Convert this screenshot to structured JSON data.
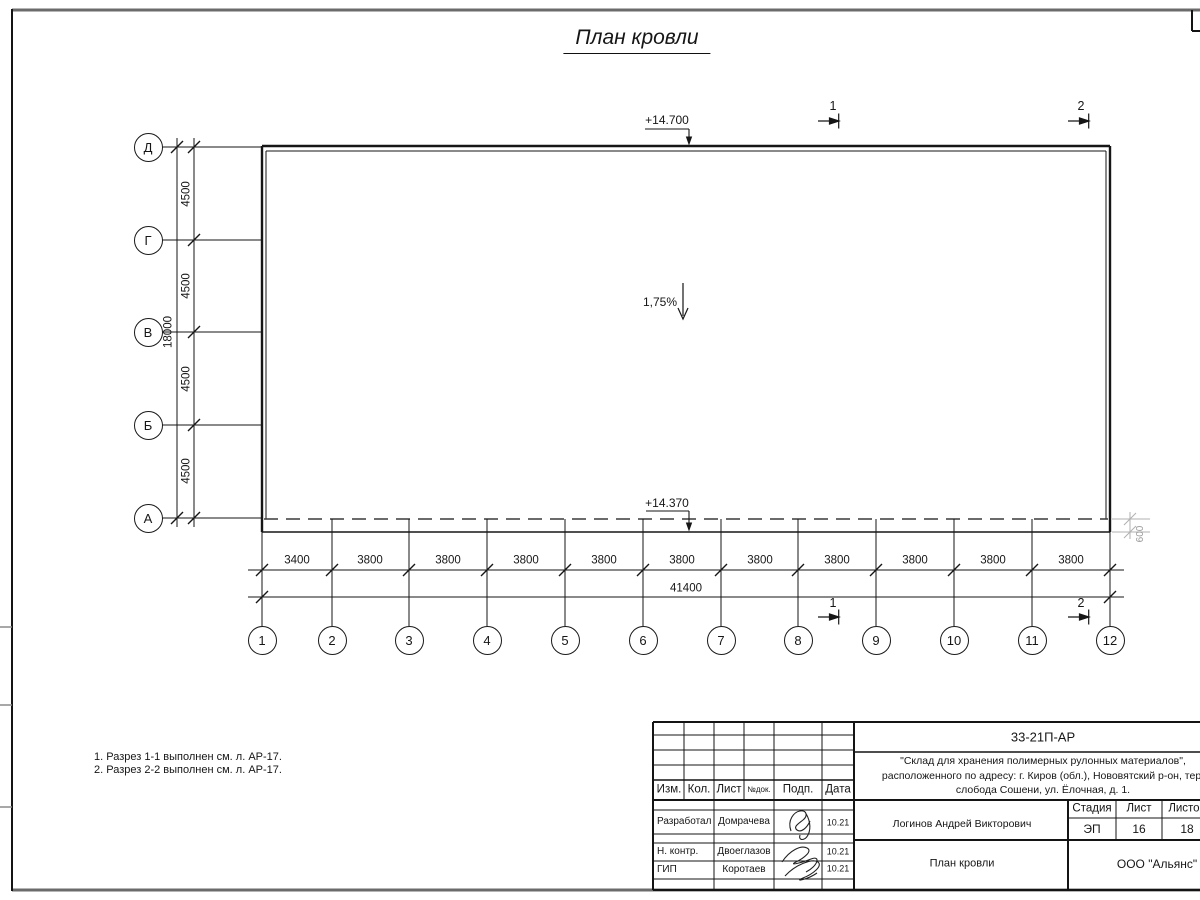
{
  "sheet_title": "План кровли",
  "axes": {
    "rows": [
      "Д",
      "Г",
      "В",
      "Б",
      "А"
    ],
    "cols": [
      "1",
      "2",
      "3",
      "4",
      "5",
      "6",
      "7",
      "8",
      "9",
      "10",
      "11",
      "12"
    ]
  },
  "dims": {
    "row_segments": [
      "4500",
      "4500",
      "4500",
      "4500"
    ],
    "row_total": "18000",
    "col_segments": [
      "3400",
      "3800",
      "3800",
      "3800",
      "3800",
      "3800",
      "3800",
      "3800",
      "3800",
      "3800",
      "3800"
    ],
    "col_total": "41400",
    "edge_offset": "600"
  },
  "marks": {
    "elevation_top": "+14.700",
    "elevation_bottom": "+14.370",
    "slope": "1,75%",
    "section_1": "1",
    "section_2": "2"
  },
  "notes": [
    "1. Разрез 1-1 выполнен см. л. АР-17.",
    "2. Разрез 2-2 выполнен см. л. АР-17."
  ],
  "title_block": {
    "doc_code": "33-21П-АР",
    "project": [
      "\"Склад для хранения полимерных рулонных материалов\",",
      "расположенного по адресу: г. Киров (обл.), Нововятский р-он, тер.",
      "слобода Сошени, ул. Ёлочная, д. 1."
    ],
    "columns": [
      "Изм.",
      "Кол.",
      "Лист",
      "№док.",
      "Подп.",
      "Дата"
    ],
    "signers": [
      {
        "role": "Разработал",
        "name": "Домрачева",
        "date": "10.21"
      },
      {
        "role": "Н. контр.",
        "name": "Двоеглазов",
        "date": "10.21"
      },
      {
        "role": "ГИП",
        "name": "Коротаев",
        "date": "10.21"
      }
    ],
    "approver": "Логинов Андрей Викторович",
    "stage_label": "Стадия",
    "sheet_label": "Лист",
    "sheets_label": "Листов",
    "stage": "ЭП",
    "sheet_no": "16",
    "sheets_total": "18",
    "drawing_name": "План кровли",
    "company": "ООО \"Альянс\""
  },
  "colors": {
    "line": "#1a1a1a",
    "light": "#a8a8a8"
  }
}
